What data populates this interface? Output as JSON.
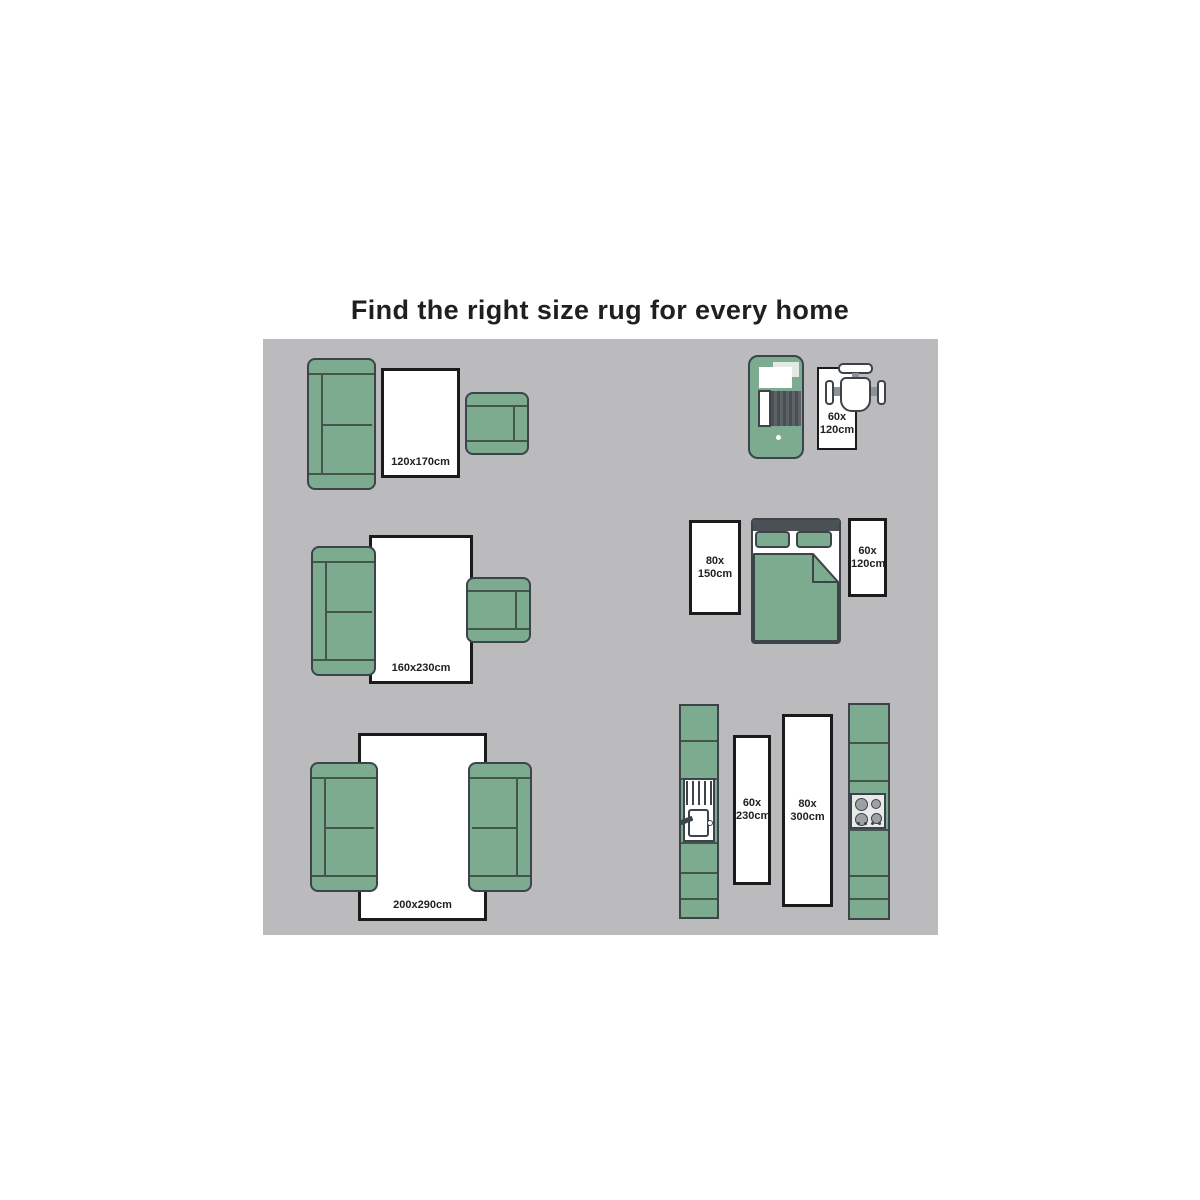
{
  "title": "Find the right size rug for every home",
  "colors": {
    "green": "#7dab90",
    "green-line": "#44554c",
    "outline": "#3c4449",
    "rug-border": "#1b1b1b",
    "panel": "#bbbbbd",
    "dark": "#4b5054",
    "text": "#1f1f1f"
  },
  "scenes": {
    "living_small": {
      "rug_size": "120x170cm"
    },
    "living_medium": {
      "rug_size": "160x230cm"
    },
    "living_large": {
      "rug_size": "200x290cm"
    },
    "entry": {
      "rug_size_lines": [
        "60x",
        "120cm"
      ]
    },
    "bedroom": {
      "left_rug_size_lines": [
        "80x",
        "150cm"
      ],
      "right_rug_size_lines": [
        "60x",
        "120cm"
      ]
    },
    "kitchen": {
      "left_rug_size_lines": [
        "60x",
        "230cm"
      ],
      "right_rug_size_lines": [
        "80x",
        "300cm"
      ]
    }
  }
}
